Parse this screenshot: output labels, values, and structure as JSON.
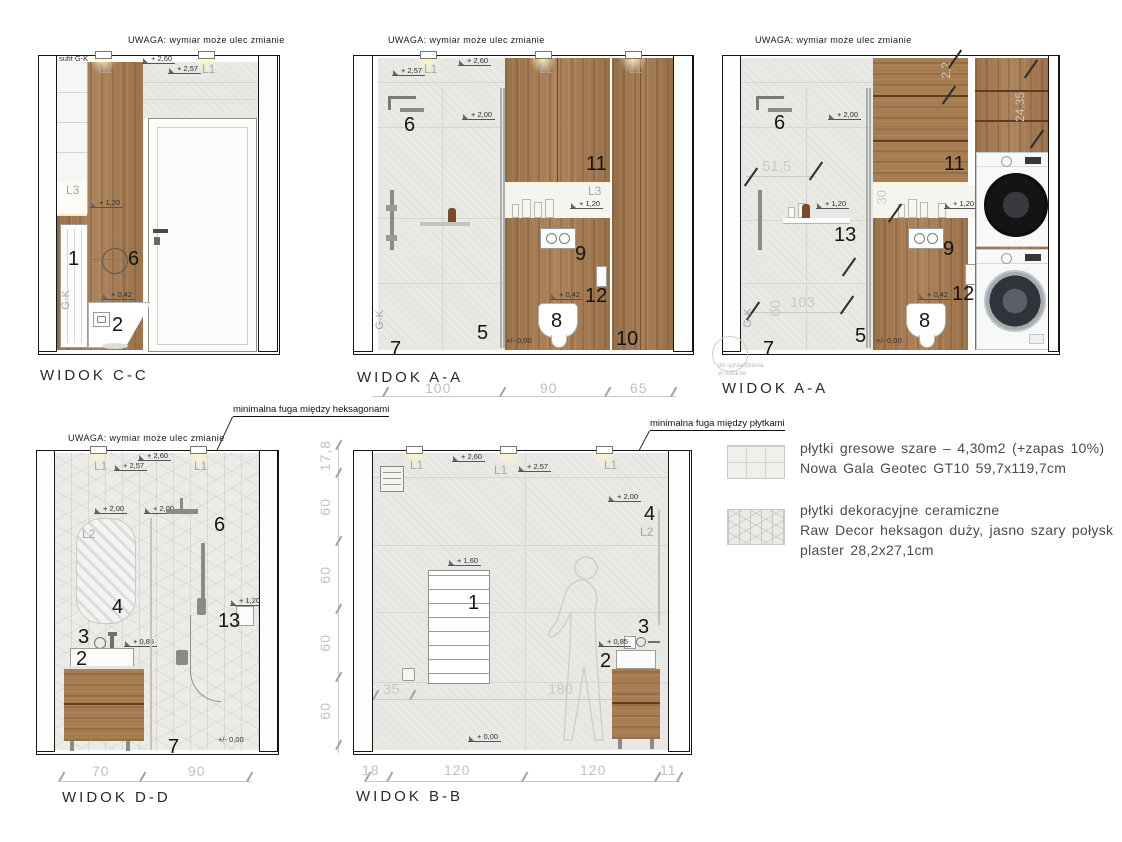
{
  "note": {
    "uwaga": "UWAGA: wymiar może ulec zmianie",
    "sufit": "sufit G-K",
    "gk": "G-K",
    "check1": "do sprawdzenia",
    "check2": "w naturze"
  },
  "lights": {
    "l1": "L1",
    "l2": "L2",
    "l3": "L3"
  },
  "levels": {
    "v260": "+ 2,60",
    "v257": "+ 2,57",
    "v200": "+ 2,00",
    "v160": "+ 1,60",
    "v120": "+ 1,20",
    "v085": "+ 0,85",
    "v042": "+ 0,42",
    "v000": "+/- 0,00",
    "v000b": "+ 0,00"
  },
  "nums": {
    "n1": "1",
    "n2": "2",
    "n3": "3",
    "n4": "4",
    "n5": "5",
    "n6": "6",
    "n7": "7",
    "n8": "8",
    "n9": "9",
    "n10": "10",
    "n11": "11",
    "n12": "12",
    "n13": "13"
  },
  "views": {
    "cc": {
      "title": "WIDOK C-C"
    },
    "aa1": {
      "title": "WIDOK A-A",
      "dims": [
        "100",
        "90",
        "65"
      ]
    },
    "aa2": {
      "title": "WIDOK A-A",
      "pencil": {
        "w515": "51,5",
        "w30": "30",
        "w103": "103",
        "w60": "60",
        "w22": "2,2",
        "w2435": "24,35"
      }
    },
    "dd": {
      "title": "WIDOK D-D",
      "callout": "minimalna fuga między heksagonami",
      "dims": [
        "70",
        "90"
      ]
    },
    "bb": {
      "title": "WIDOK B-B",
      "callout": "minimalna fuga między płytkami",
      "dims_bottom": [
        "18",
        "120",
        "120",
        "11"
      ],
      "dims_left": [
        "17,8",
        "60",
        "60",
        "60",
        "60"
      ],
      "pencil_a": "35",
      "pencil_b": "180"
    }
  },
  "legend": {
    "items": [
      {
        "line1": "płytki gresowe szare – 4,30m2 (+zapas 10%)",
        "line2": "Nowa Gala Geotec GT10 59,7x119,7cm"
      },
      {
        "line1": "płytki dekoracyjne ceramiczne",
        "line2": "Raw Decor heksagon duży, jasno szary połysk",
        "line3": "plaster 28,2x27,1cm"
      }
    ]
  }
}
